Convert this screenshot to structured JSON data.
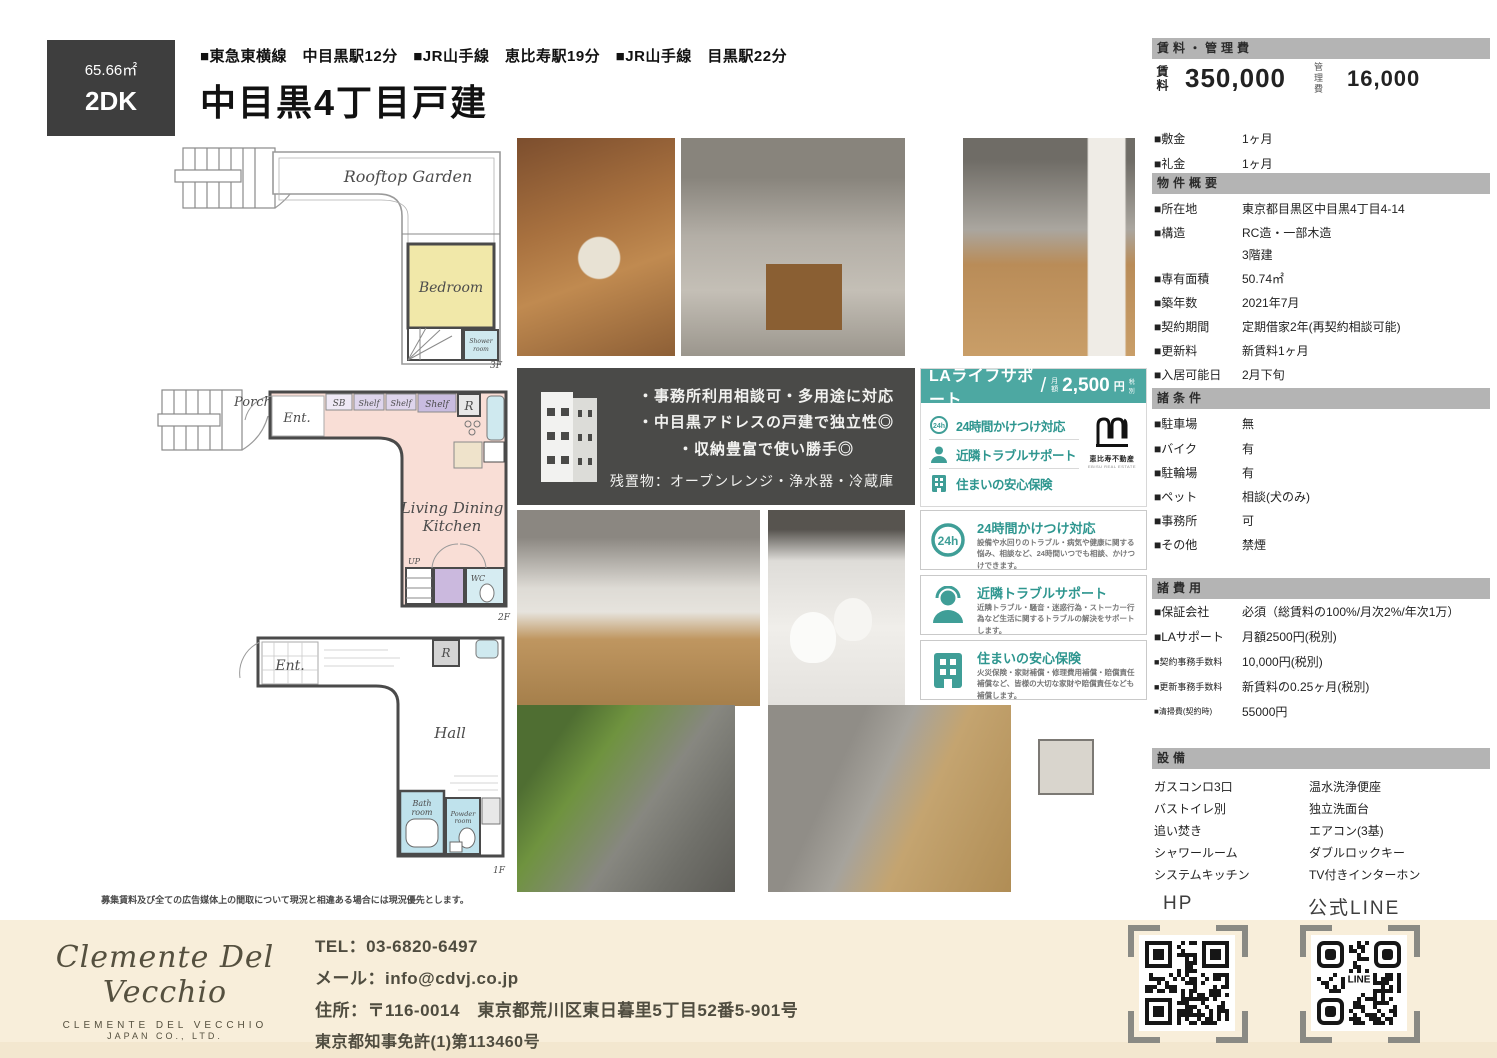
{
  "badge": {
    "area": "65.66㎡",
    "layout": "2DK"
  },
  "header": {
    "train_line": "■東急東横線　中目黒駅12分　■JR山手線　恵比寿駅19分　■JR山手線　目黒駅22分",
    "title": "中目黒4丁目戸建"
  },
  "floorplans": {
    "f3": {
      "label": "3F",
      "rooftop": "Rooftop Garden",
      "bedroom": "Bedroom",
      "shower1": "Shower",
      "shower2": "room"
    },
    "f2": {
      "label": "2F",
      "porch": "Porch",
      "ent": "Ent.",
      "sb": "SB",
      "shelf1": "Shelf",
      "shelf2": "Shelf",
      "shelf3": "Shelf",
      "r": "R",
      "ldk1": "Living Dining",
      "ldk2": "Kitchen",
      "up": "UP",
      "wc": "WC"
    },
    "f1": {
      "label": "1F",
      "ent": "Ent.",
      "r": "R",
      "hall": "Hall",
      "bath1": "Bath",
      "bath2": "room",
      "powder1": "Powder",
      "powder2": "room"
    },
    "disclaimer": "募集賃料及び全ての広告媒体上の間取について現況と相違ある場合には現況優先とします。"
  },
  "feature_box": {
    "line1": "・事務所利用相談可・多用途に対応",
    "line2": "・中目黒アドレスの戸建で独立性◎",
    "line3": "・収納豊富で使い勝手◎",
    "note": "残置物：オーブンレンジ・浄水器・冷蔵庫"
  },
  "la_support": {
    "title": "LAライフサポート",
    "slash": "/",
    "price_prefix": "月額",
    "price": "2,500",
    "unit": "円",
    "tax": "税別",
    "item1": "24時間かけつけ対応",
    "item2": "近隣トラブルサポート",
    "item3": "住まいの安心保険",
    "icon24_text": "24h",
    "logo_name": "恵比寿不動産",
    "logo_sub": "EBISU REAL ESTATE",
    "details": [
      {
        "title": "24時間かけつけ対応",
        "desc": "設備や水回りのトラブル・病気や健康に関する悩み、相談など、24時間いつでも相談、かけつけできます。"
      },
      {
        "title": "近隣トラブルサポート",
        "desc": "近隣トラブル・騒音・迷惑行為・ストーカー行為など生活に関するトラブルの解決をサポートします。"
      },
      {
        "title": "住まいの安心保険",
        "desc": "火災保険・家財補償・修理費用補償・賠償責任補償など、皆様の大切な家財や賠償責任なども補償します。"
      }
    ]
  },
  "sidebar": {
    "rent": {
      "header": "賃料・管理費",
      "rent_label": "賃料",
      "rent_value": "350,000",
      "mgmt_label": "管理費",
      "mgmt_value": "16,000",
      "rows": [
        {
          "label": "■敷金",
          "value": "1ヶ月"
        },
        {
          "label": "■礼金",
          "value": "1ヶ月"
        }
      ]
    },
    "outline": {
      "header": "物件概要",
      "rows": [
        {
          "label": "■所在地",
          "value": "東京都目黒区中目黒4丁目4-14"
        },
        {
          "label": "■構造",
          "value": "RC造・一部木造"
        },
        {
          "label": "",
          "value": "3階建"
        },
        {
          "label": "■専有面積",
          "value": "50.74㎡"
        },
        {
          "label": "■築年数",
          "value": "2021年7月"
        },
        {
          "label": "■契約期間",
          "value": "定期借家2年(再契約相談可能)"
        },
        {
          "label": "■更新料",
          "value": "新賃料1ヶ月"
        },
        {
          "label": "■入居可能日",
          "value": "2月下旬"
        }
      ]
    },
    "conditions": {
      "header": "諸条件",
      "rows": [
        {
          "label": "■駐車場",
          "value": "無"
        },
        {
          "label": "■バイク",
          "value": "有"
        },
        {
          "label": "■駐輪場",
          "value": "有"
        },
        {
          "label": "■ペット",
          "value": "相談(犬のみ)"
        },
        {
          "label": "■事務所",
          "value": "可"
        },
        {
          "label": "■その他",
          "value": "禁煙"
        }
      ]
    },
    "fees": {
      "header": "諸費用",
      "rows": [
        {
          "label": "■保証会社",
          "value": "必須（総賃料の100%/月次2%/年次1万）"
        },
        {
          "label": "■LAサポート",
          "value": "月額2500円(税別)"
        },
        {
          "label": "■契約事務手数料",
          "value": "10,000円(税別)"
        },
        {
          "label": "■更新事務手数料",
          "value": "新賃料の0.25ヶ月(税別)"
        },
        {
          "label": "■清掃費(契約時)",
          "value": "55000円"
        }
      ]
    },
    "equipment": {
      "header": "設備",
      "left": [
        "ガスコンロ3口",
        "バストイレ別",
        "追い焚き",
        "シャワールーム",
        "システムキッチン"
      ],
      "right": [
        "温水洗浄便座",
        "独立洗面台",
        "エアコン(3基)",
        "ダブルロックキー",
        "TV付きインターホン"
      ]
    }
  },
  "qr": {
    "hp_label": "HP",
    "line_label": "公式LINE",
    "line_text": "LINE"
  },
  "footer": {
    "logo_script": "Clemente Del Vecchio",
    "logo_name": "CLEMENTE DEL VECCHIO",
    "logo_sub": "JAPAN CO., LTD.",
    "tel": "TEL：03-6820-6497",
    "email": "メール：info@cdvj.co.jp",
    "address": "住所：〒116-0014　東京都荒川区東日暮里5丁目52番5-901号",
    "license": "東京都知事免許(1)第113460号"
  }
}
